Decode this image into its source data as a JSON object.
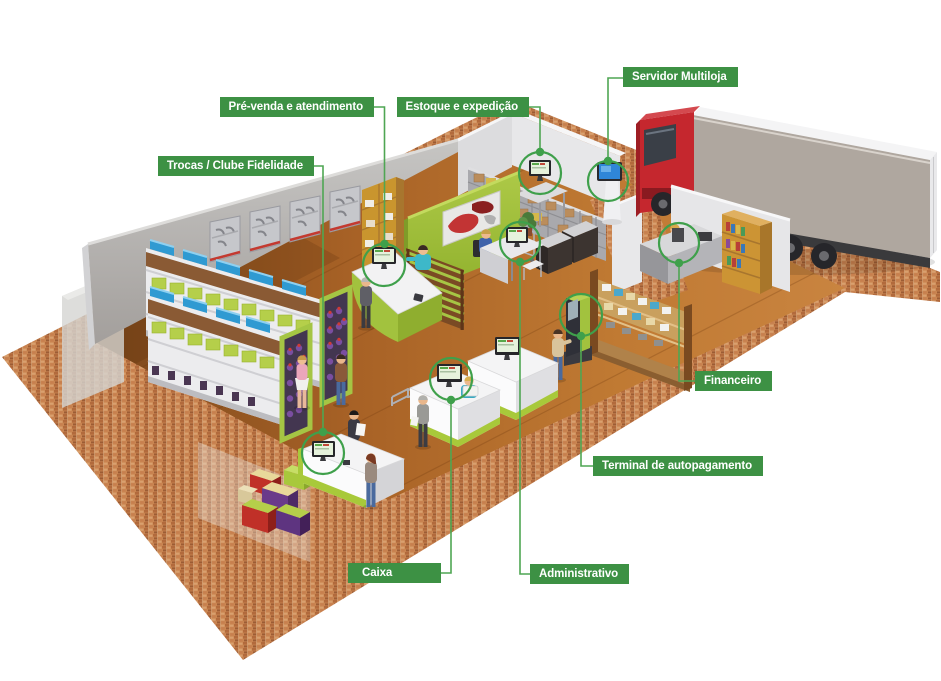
{
  "diagram": {
    "type": "isometric-store-layout",
    "language": "pt-BR",
    "callouts": {
      "prevenda": "Pré-venda e atendimento",
      "estoque": "Estoque e expedição",
      "servidor": "Servidor Multiloja",
      "trocas": "Trocas / Clube Fidelidade",
      "financeiro": "Financeiro",
      "terminal": "Terminal de autopagamento",
      "caixa": "Caixa",
      "administrativo": "Administrativo"
    },
    "colors": {
      "callout_bg": "#3d9144",
      "callout_text": "#ffffff",
      "annotation_line": "#4fa653",
      "annotation_circle": "#3fa04b",
      "accent_lime": "#a8c93a",
      "partition_green": "#a0bd3a",
      "truck_red": "#c5272e",
      "floor_wood": "#b06a2a",
      "brick": "#c98551",
      "server_screen_blue": "#2f86d8"
    }
  }
}
